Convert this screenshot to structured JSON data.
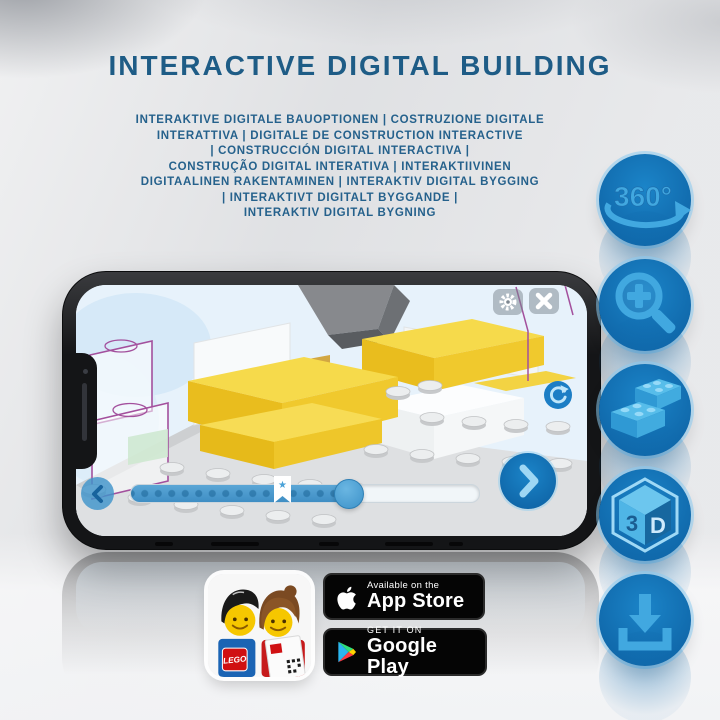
{
  "title": "INTERACTIVE DIGITAL BUILDING",
  "subtitle": {
    "lines": [
      "INTERAKTIVE DIGITALE BAUOPTIONEN | COSTRUZIONE DIGITALE",
      "INTERATTIVA | DIGITALE DE CONSTRUCTION INTERACTIVE",
      "| CONSTRUCCIÓN DIGITAL INTERACTIVA |",
      "CONSTRUÇÃO DIGITAL INTERATIVA | INTERAKTIIVINEN",
      "DIGITAALINEN RAKENTAMINEN | INTERAKTIV DIGITAL BYGGING",
      "| INTERAKTIVT DIGITALT BYGGANDE |",
      "INTERAKTIV DIGITAL BYGNING"
    ]
  },
  "feature_icons": {
    "names": [
      "360-rotation",
      "zoom-in",
      "bricks",
      "3d-view",
      "download"
    ],
    "rotate_label": "360°",
    "cube_left": "3",
    "cube_right": "D"
  },
  "phone": {
    "slider_bookmark_star": "★"
  },
  "badges": {
    "app_store": {
      "line1": "Available on the",
      "line2": "App Store"
    },
    "google_play": {
      "line1": "GET IT ON",
      "line2": "Google Play"
    },
    "lego_app": {
      "logo_text": "LEGO"
    }
  },
  "colors": {
    "title_blue": "#1e5c86",
    "icon_circle_blue": "#1173b9",
    "icon_glyph_blue": "#41a8e0",
    "brick_yellow": "#f2cf35",
    "screen_bg": "#e7f2fb"
  }
}
